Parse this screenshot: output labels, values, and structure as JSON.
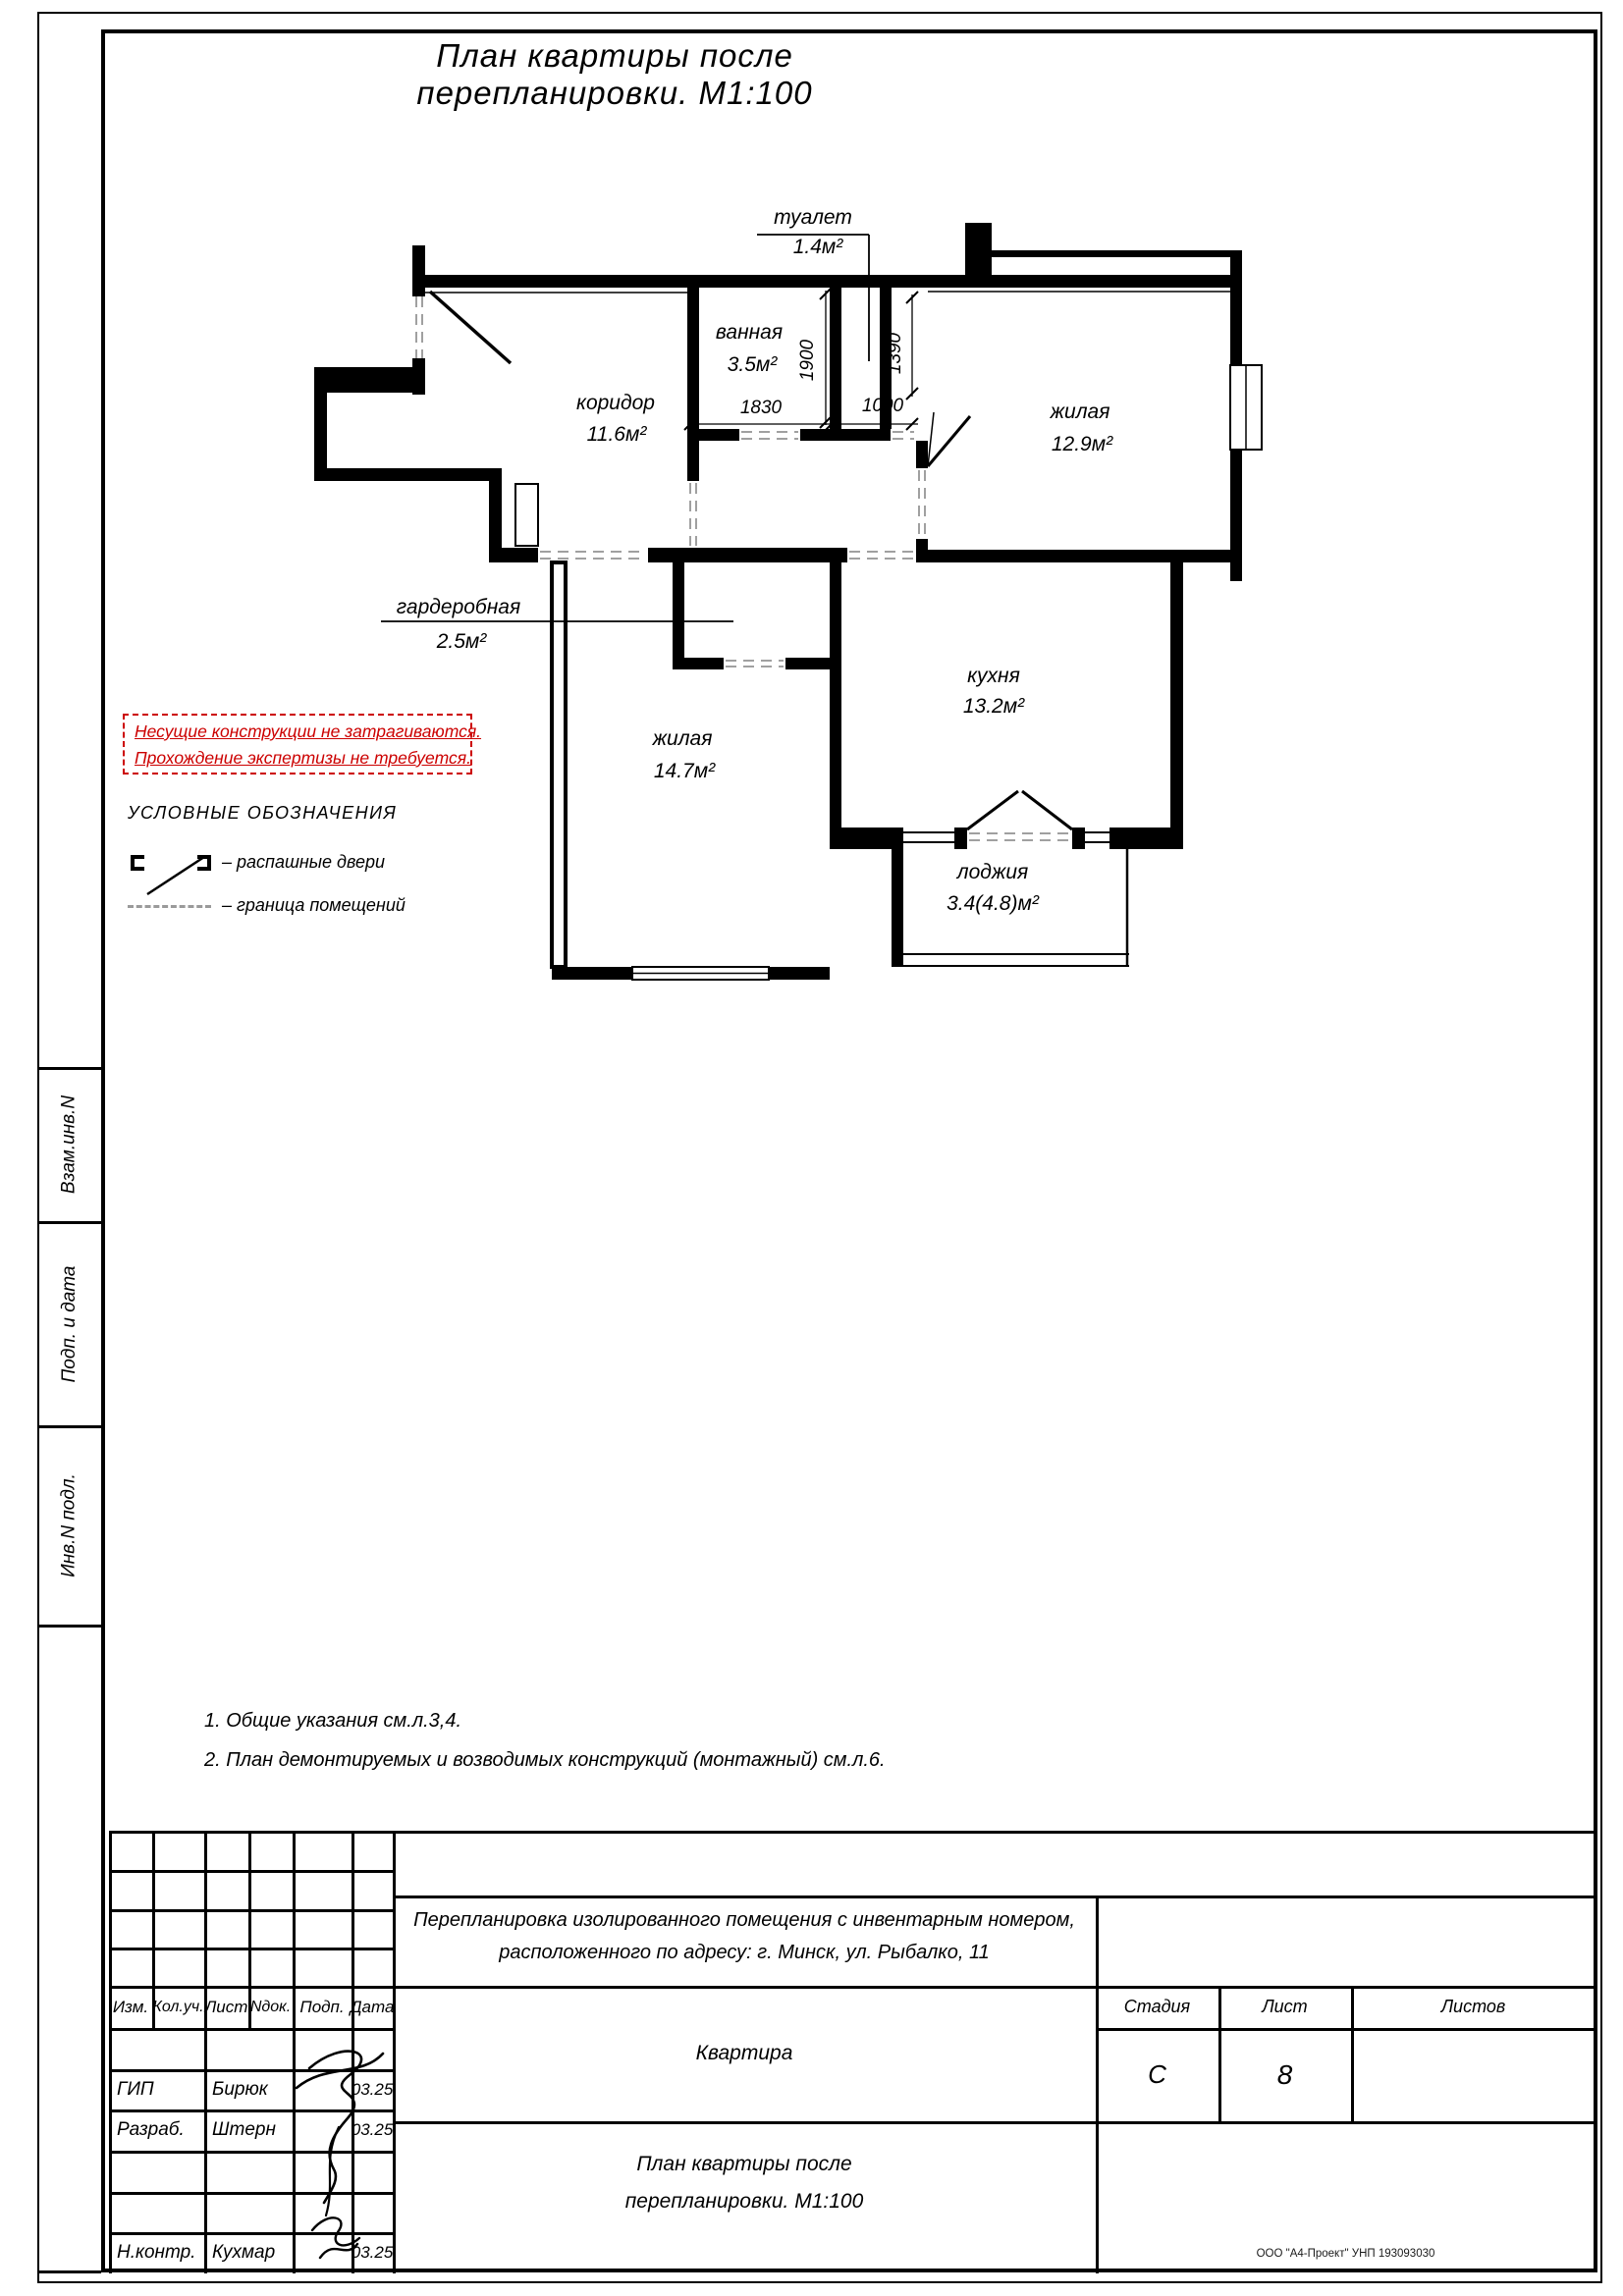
{
  "sheet": {
    "title": "План квартиры после перепланировки. М1:100"
  },
  "plan": {
    "rooms": {
      "toilet": {
        "name": "туалет",
        "area": "1.4м²"
      },
      "bath": {
        "name": "ванная",
        "area": "3.5м²"
      },
      "corridor": {
        "name": "коридор",
        "area": "11.6м²"
      },
      "living1": {
        "name": "жилая",
        "area": "12.9м²"
      },
      "wardrobe": {
        "name": "гардеробная",
        "area": "2.5м²"
      },
      "living2": {
        "name": "жилая",
        "area": "14.7м²"
      },
      "kitchen": {
        "name": "кухня",
        "area": "13.2м²"
      },
      "loggia": {
        "name": "лоджия",
        "area": "3.4(4.8)м²"
      }
    },
    "dims": {
      "bath_width": "1830",
      "toilet_width": "1000",
      "bath_depth": "1900",
      "toilet_depth": "1390"
    }
  },
  "warning": {
    "line1": "Несущие конструкции не затрагиваются.",
    "line2": "Прохождение экспертизы не требуется.",
    "color": "#cc0000"
  },
  "legend": {
    "title": "УСЛОВНЫЕ ОБОЗНАЧЕНИЯ",
    "door_label": "– распашные двери",
    "boundary_label": "– граница помещений"
  },
  "notes": {
    "n1": "1. Общие указания см.л.3,4.",
    "n2": "2. План демонтируемых и возводимых конструкций (монтажный) см.л.6."
  },
  "margin": {
    "box1": "Взам.инв.N",
    "box2": "Подп. и дата",
    "box3": "Инв.N подл."
  },
  "titleblock": {
    "cols": {
      "c1": "Изм.",
      "c2": "Кол.уч.",
      "c3": "Лист",
      "c4": "Nдок.",
      "c5": "Подп.",
      "c6": "Дата"
    },
    "staff": {
      "r1": {
        "role": "ГИП",
        "name": "Бирюк",
        "date": "03.25"
      },
      "r2": {
        "role": "Разраб.",
        "name": "Штерн",
        "date": "03.25"
      },
      "r3": {
        "role": "Н.контр.",
        "name": "Кухмар",
        "date": "03.25"
      }
    },
    "project_line1": "Перепланировка изолированного помещения с инвентарным номером,",
    "project_line2": "расположенного по адресу: г. Минск, ул. Рыбалко, 11",
    "object": "Квартира",
    "stage_label": "Стадия",
    "sheet_label": "Лист",
    "sheets_label": "Листов",
    "stage": "С",
    "sheet_no": "8",
    "name_line1": "План квартиры после",
    "name_line2": "перепланировки. М1:100",
    "company": "ООО \"А4-Проект\" УНП 193093030"
  }
}
